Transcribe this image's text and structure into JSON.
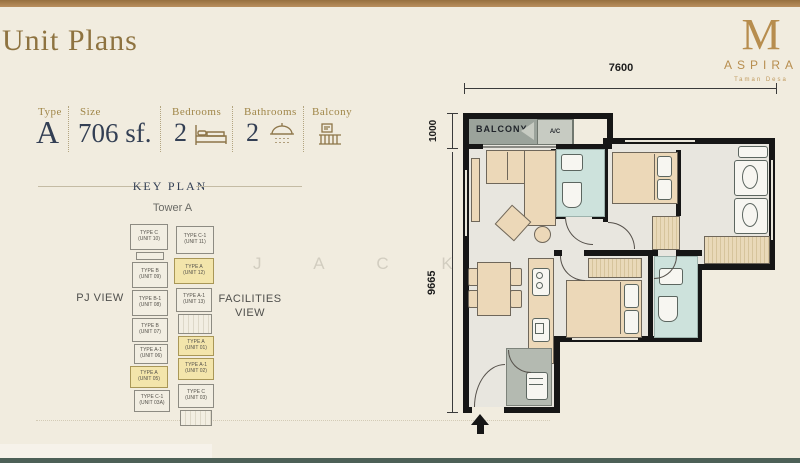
{
  "page": {
    "title": "Unit Plans",
    "watermark_letters": "J A C K"
  },
  "brand": {
    "monogram": "M",
    "name": "ASPIRA",
    "tagline": "Taman Desa"
  },
  "specs": {
    "type_label": "Type",
    "type_value": "A",
    "size_label": "Size",
    "size_value": "706 sf.",
    "bedrooms_label": "Bedrooms",
    "bedrooms_value": "2",
    "bathrooms_label": "Bathrooms",
    "bathrooms_value": "2",
    "balcony_label": "Balcony"
  },
  "key_plan": {
    "heading": "KEY PLAN",
    "tower_label": "Tower A",
    "left_view": "PJ VIEW",
    "right_view": "FACILITIES VIEW",
    "highlight_color": "#f3e5ab",
    "units": [
      {
        "type": "TYPE C",
        "unit": "(UNIT 10)",
        "x": 0,
        "y": 6,
        "w": 38,
        "h": 26,
        "hl": false
      },
      {
        "type": "TYPE C-1",
        "unit": "(UNIT 11)",
        "x": 46,
        "y": 8,
        "w": 38,
        "h": 28,
        "hl": false
      },
      {
        "type": "TYPE B",
        "unit": "(UNIT 09)",
        "x": 2,
        "y": 44,
        "w": 36,
        "h": 26,
        "hl": false
      },
      {
        "type": "TYPE A",
        "unit": "(UNIT 12)",
        "x": 44,
        "y": 40,
        "w": 40,
        "h": 26,
        "hl": true
      },
      {
        "type": "TYPE B-1",
        "unit": "(UNIT 08)",
        "x": 2,
        "y": 72,
        "w": 36,
        "h": 26,
        "hl": false
      },
      {
        "type": "TYPE A-1",
        "unit": "(UNIT 13)",
        "x": 46,
        "y": 70,
        "w": 36,
        "h": 24,
        "hl": false
      },
      {
        "type": "TYPE B",
        "unit": "(UNIT 07)",
        "x": 2,
        "y": 100,
        "w": 36,
        "h": 24,
        "hl": false
      },
      {
        "type": "TYPE A-1",
        "unit": "(UNIT 06)",
        "x": 4,
        "y": 126,
        "w": 34,
        "h": 20,
        "hl": false
      },
      {
        "type": "TYPE A",
        "unit": "(UNIT 05)",
        "x": 0,
        "y": 148,
        "w": 38,
        "h": 22,
        "hl": true
      },
      {
        "type": "TYPE C-1",
        "unit": "(UNIT 03A)",
        "x": 4,
        "y": 172,
        "w": 36,
        "h": 22,
        "hl": false
      },
      {
        "type": "TYPE A",
        "unit": "(UNIT 01)",
        "x": 48,
        "y": 118,
        "w": 36,
        "h": 20,
        "hl": true
      },
      {
        "type": "TYPE A-1",
        "unit": "(UNIT 02)",
        "x": 48,
        "y": 140,
        "w": 36,
        "h": 22,
        "hl": true
      },
      {
        "type": "TYPE C",
        "unit": "(UNIT 03)",
        "x": 48,
        "y": 166,
        "w": 36,
        "h": 24,
        "hl": false
      }
    ]
  },
  "floor_plan": {
    "width_dim": "7600",
    "balcony_dim": "1000",
    "height_dim": "9665",
    "balcony_label": "BALCONY",
    "ac_label": "A/C"
  },
  "colors": {
    "accent_gold": "#8e7340",
    "navy": "#333f54",
    "top_bar": "#a87e4f",
    "bottom_bar": "#4d6057",
    "bathroom_teal": "#cde2dc",
    "furniture_beige": "#ecd8b8",
    "keyplan_highlight": "#f3e5ab"
  }
}
